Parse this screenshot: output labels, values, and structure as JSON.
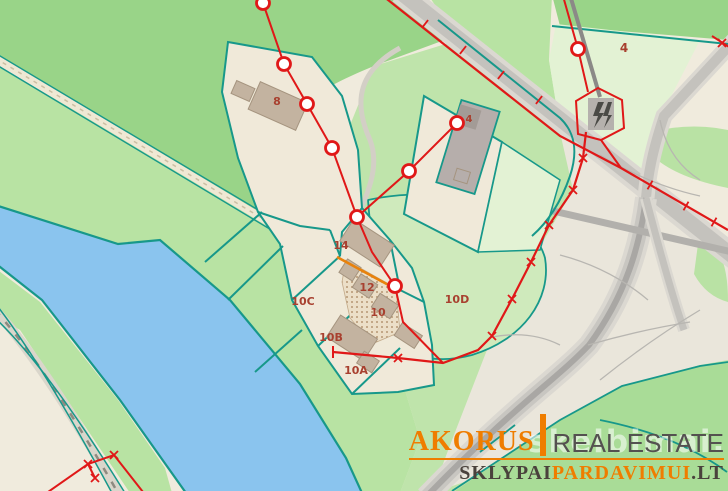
{
  "map": {
    "description": "cadastral land plot map",
    "labels": [
      {
        "text": "8",
        "x": 277,
        "y": 105,
        "size": 11
      },
      {
        "text": "4",
        "x": 624,
        "y": 52,
        "size": 12
      },
      {
        "text": "4",
        "x": 469,
        "y": 122,
        "size": 10
      },
      {
        "text": "14",
        "x": 341,
        "y": 249,
        "size": 11
      },
      {
        "text": "12",
        "x": 367,
        "y": 291,
        "size": 11
      },
      {
        "text": "10",
        "x": 378,
        "y": 316,
        "size": 11
      },
      {
        "text": "10C",
        "x": 303,
        "y": 305,
        "size": 11
      },
      {
        "text": "10B",
        "x": 331,
        "y": 341,
        "size": 11
      },
      {
        "text": "10A",
        "x": 356,
        "y": 374,
        "size": 11
      },
      {
        "text": "10D",
        "x": 457,
        "y": 303,
        "size": 11
      }
    ],
    "colors": {
      "forest_green": "#99d488",
      "meadow_green": "#b8e3a3",
      "field_green": "#bfe4ab",
      "pasture_green": "#cfeabc",
      "pale_field_green": "#e3f2d4",
      "bottom_green": "#a9dc97",
      "water_blue": "#8ac4ee",
      "parcel_boundary_teal": "#17988a",
      "survey_red": "#e01818",
      "utility_orange": "#e8820c",
      "road_gray": "#c4c2bd",
      "building_tan": "#c3b3a0",
      "building_gray": "#b6aeab",
      "farmyard_beige": "#f0e9d9",
      "label_red": "#a8402f"
    }
  },
  "watermark": {
    "background_text": "skelbimai.lt"
  },
  "logo": {
    "brand": "AKORUS",
    "brand_suffix": "REAL ESTATE",
    "tagline_part1": "SKLYPAI",
    "tagline_part2": "PARDAVIMUI",
    "tagline_part3": ".LT"
  }
}
